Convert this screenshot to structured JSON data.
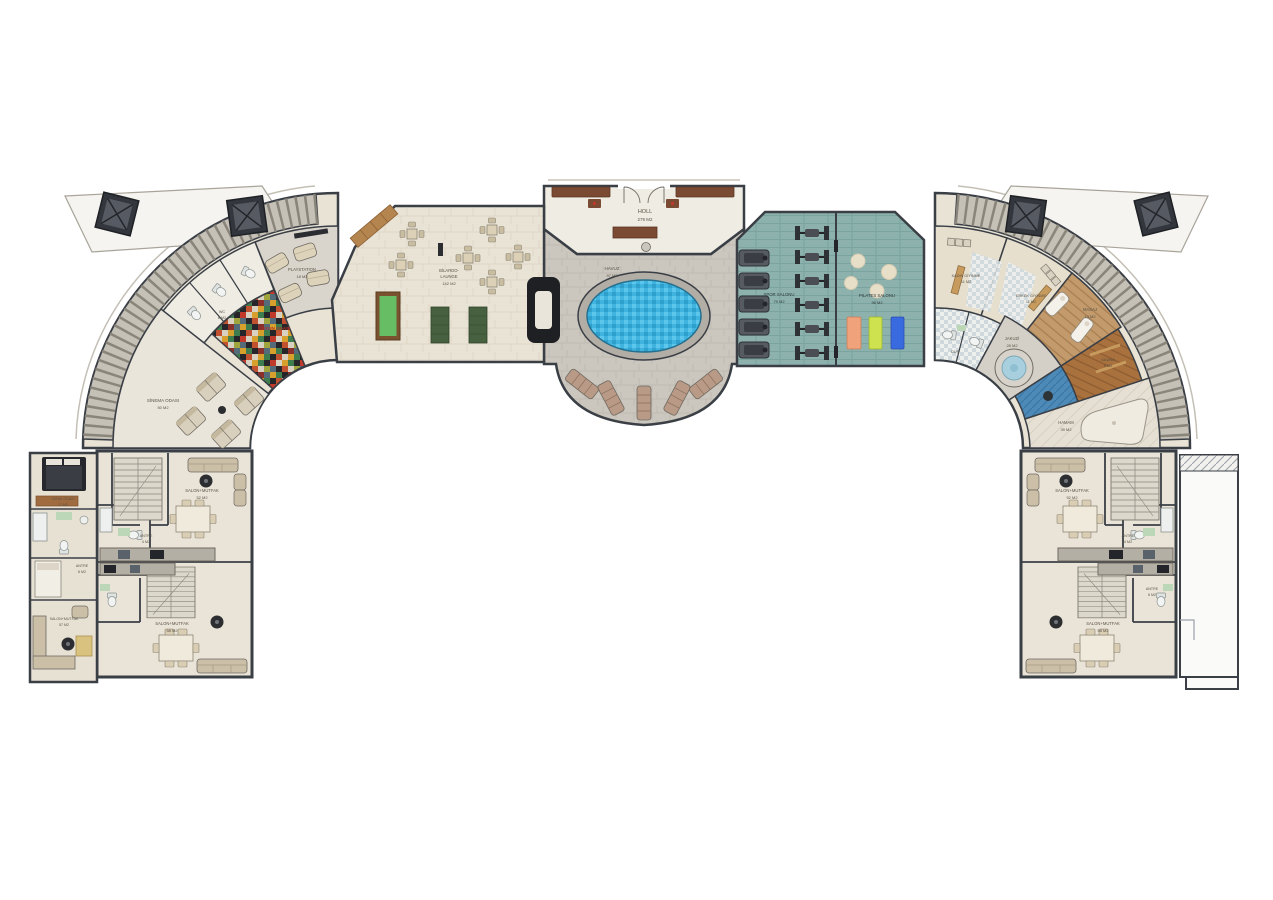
{
  "page": {
    "type": "architectural floor plan",
    "background": "#ffffff"
  },
  "labels": {
    "holl": {
      "name": "HOLL",
      "area": "279 M2"
    },
    "havuz": {
      "name": "HAVUZ",
      "area": "97 M2"
    },
    "bilardo": {
      "line1": "BİLARDO-",
      "line2": "LAUNGE",
      "area": "142 M2"
    },
    "spor": {
      "name": "SPOR SALONU",
      "area": "79 M2"
    },
    "pilates": {
      "name": "PILATES SALONU",
      "area": "96 M2"
    },
    "playstation": {
      "name": "PLAYSTATION",
      "area": "18 M2"
    },
    "oyun": {
      "name": "OYUN ODASI"
    },
    "sinema": {
      "name": "SİNEMA ODASI",
      "area": "50 M2"
    },
    "wc": {
      "name": "WC",
      "area": "6 M2"
    },
    "dus": {
      "name": "DUŞ"
    },
    "kadin_giyinme": {
      "name": "KADIN GİYİNME",
      "area": "11 M2"
    },
    "erkek_giyinme": {
      "name": "ERKEK GİYİNME",
      "area": "11 M2"
    },
    "masaj": {
      "name": "MASAJ",
      "area": "13 M2"
    },
    "jakuzi": {
      "name": "JAKUZİ",
      "area": "28 M2"
    },
    "sauna": {
      "name": "SAUNA",
      "area": "9 M2"
    },
    "hamam": {
      "name": "HAMAM",
      "area": "39 M2"
    },
    "salon_left_top": {
      "name": "SALON+MUTFAK",
      "area": "52 M2"
    },
    "salon_left_bottom": {
      "name": "SALON+MUTFAK",
      "area": "58 M2"
    },
    "salon_left_annex": {
      "name": "SALON+MUTFAK",
      "area": "57 M2"
    },
    "yatak_annex": {
      "name": "YATAK ODASI",
      "area": "17 M2"
    },
    "antre_left_top": {
      "name": "ANTRE",
      "area": "4 M2"
    },
    "antre_left_annex": {
      "name": "ANTRE",
      "area": "6 M2"
    },
    "salon_right_top": {
      "name": "SALON+MUTFAK",
      "area": "52 M2"
    },
    "salon_right_bottom": {
      "name": "SALON+MUTFAK",
      "area": "58 M2"
    },
    "antre_right_top": {
      "name": "ANTRE",
      "area": "4 M2"
    },
    "antre_right_mid": {
      "name": "ANTRE",
      "area": "6 M2"
    }
  },
  "colors": {
    "wall": "#3a3f46",
    "cream_floor": "#e9e3d6",
    "pool_deck": "#cbc6be",
    "gym_floor": "#8db2ae",
    "pool_water": "#3fb4e0",
    "sauna_wood": "#a8713e",
    "wood_furniture": "#7b4a33",
    "billiard_green": "#66bd63",
    "mat_orange": "#f0a27b",
    "mat_green": "#cde24e",
    "mat_blue": "#3a6ae0",
    "playroom_accent": "#c0392b"
  }
}
